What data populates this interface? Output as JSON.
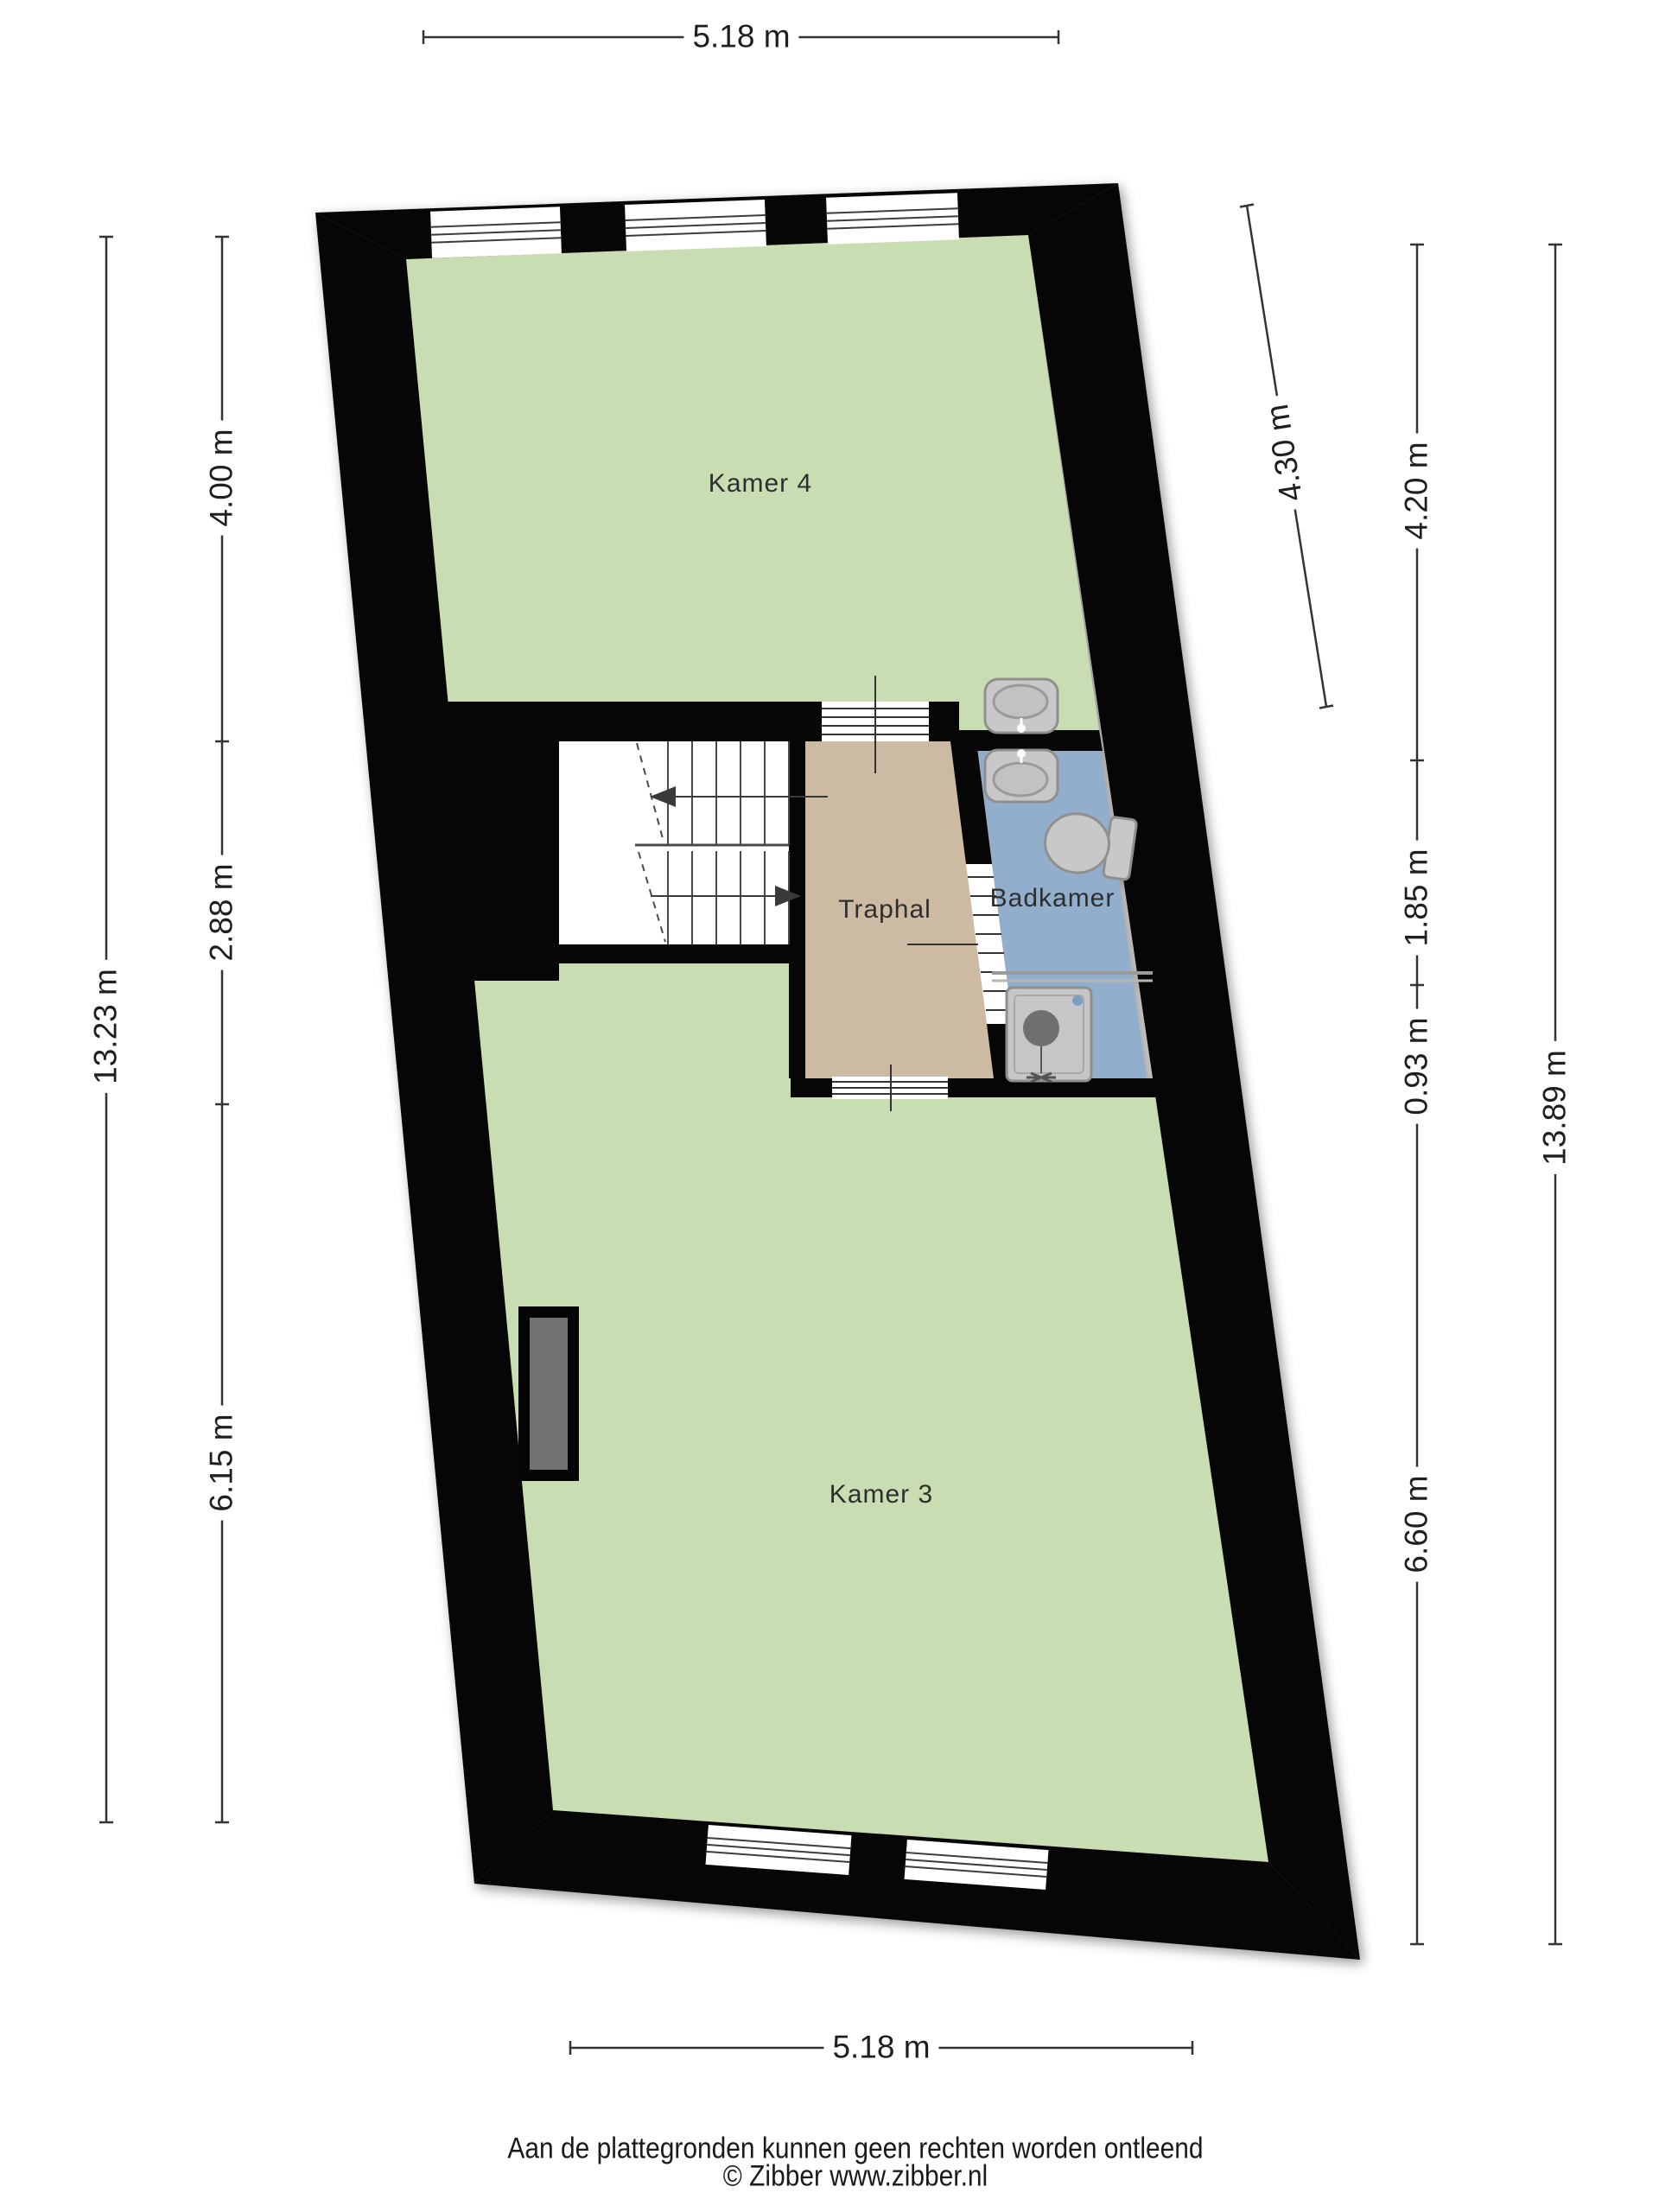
{
  "rooms": {
    "kamer4": {
      "label": "Kamer 4"
    },
    "traphal": {
      "label": "Traphal"
    },
    "badkamer": {
      "label": "Badkamer"
    },
    "kamer3": {
      "label": "Kamer 3"
    }
  },
  "dims": {
    "top": {
      "label": "5.18 m"
    },
    "bottom": {
      "label": "5.18 m"
    },
    "left_inner": {
      "segments": [
        {
          "label": "4.00 m"
        },
        {
          "label": "2.88 m"
        },
        {
          "label": "6.15 m"
        }
      ]
    },
    "left_outer": {
      "label": "13.23 m"
    },
    "right_inner": {
      "segments": [
        {
          "label": "4.20 m"
        },
        {
          "label": "1.85 m"
        },
        {
          "label": "0.93 m"
        },
        {
          "label": "6.60 m"
        }
      ]
    },
    "right_outer": {
      "label": "13.89 m"
    },
    "diagonal": {
      "label": "4.30 m"
    }
  },
  "footer": {
    "disclaimer": "Aan de plattegronden kunnen geen rechten worden ontleend",
    "copyright": "© Zibber www.zibber.nl"
  },
  "colors": {
    "wall": "#060606",
    "room_green": "#c8deb2",
    "room_tan": "#cdbaa3",
    "room_blue": "#92aecd",
    "stairs_white": "#ffffff",
    "fixture_gray": "#c8c8c8",
    "fixture_stroke": "#8f8f8f",
    "chimney_gray": "#717171",
    "dim_line": "#333333"
  }
}
